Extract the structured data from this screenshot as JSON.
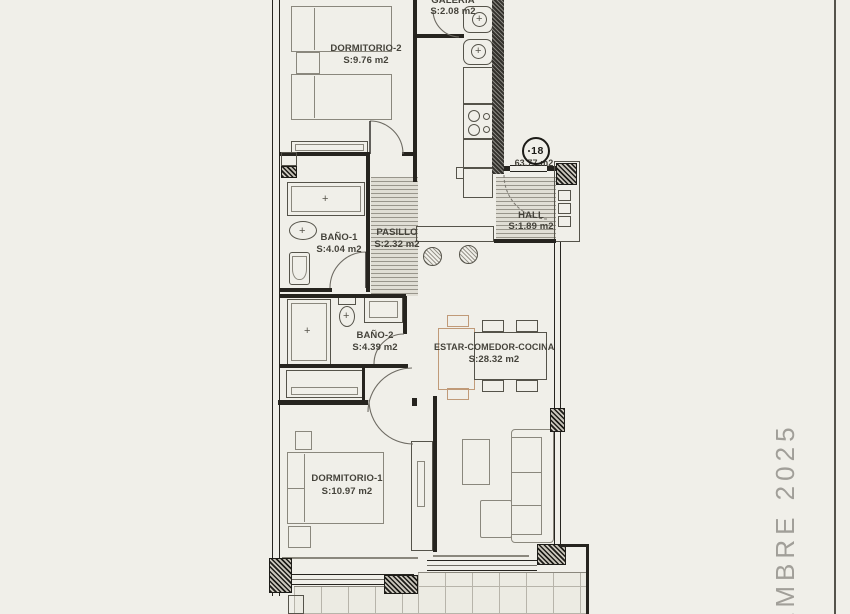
{
  "sheet": {
    "date_text": "EMBRE 2025"
  },
  "unit": {
    "number": "18",
    "total_area": "63.77 m2"
  },
  "rooms": {
    "dormitorio2": {
      "name": "DORMITORIO-2",
      "area": "S:9.76 m2"
    },
    "galeria": {
      "name": "GALERIA",
      "area": "S:2.08 m2"
    },
    "hall": {
      "name": "HALL",
      "area": "S:1.89 m2"
    },
    "bano1": {
      "name": "BAÑO-1",
      "area": "S:4.04 m2"
    },
    "pasillo": {
      "name": "PASILLO",
      "area": "S:2.32 m2"
    },
    "bano2": {
      "name": "BAÑO-2",
      "area": "S:4.39 m2"
    },
    "estar": {
      "name": "ESTAR-COMEDOR-COCINA",
      "area": "S:28.32 m2"
    },
    "dormitorio1": {
      "name": "DORMITORIO-1",
      "area": "S:10.97 m2"
    }
  },
  "colors": {
    "background": "#f0efe9",
    "walls": "#26241f",
    "accent_tan": "#c09a78",
    "floor_hatch_line": "#98958b",
    "date_text": "#a19f99"
  }
}
